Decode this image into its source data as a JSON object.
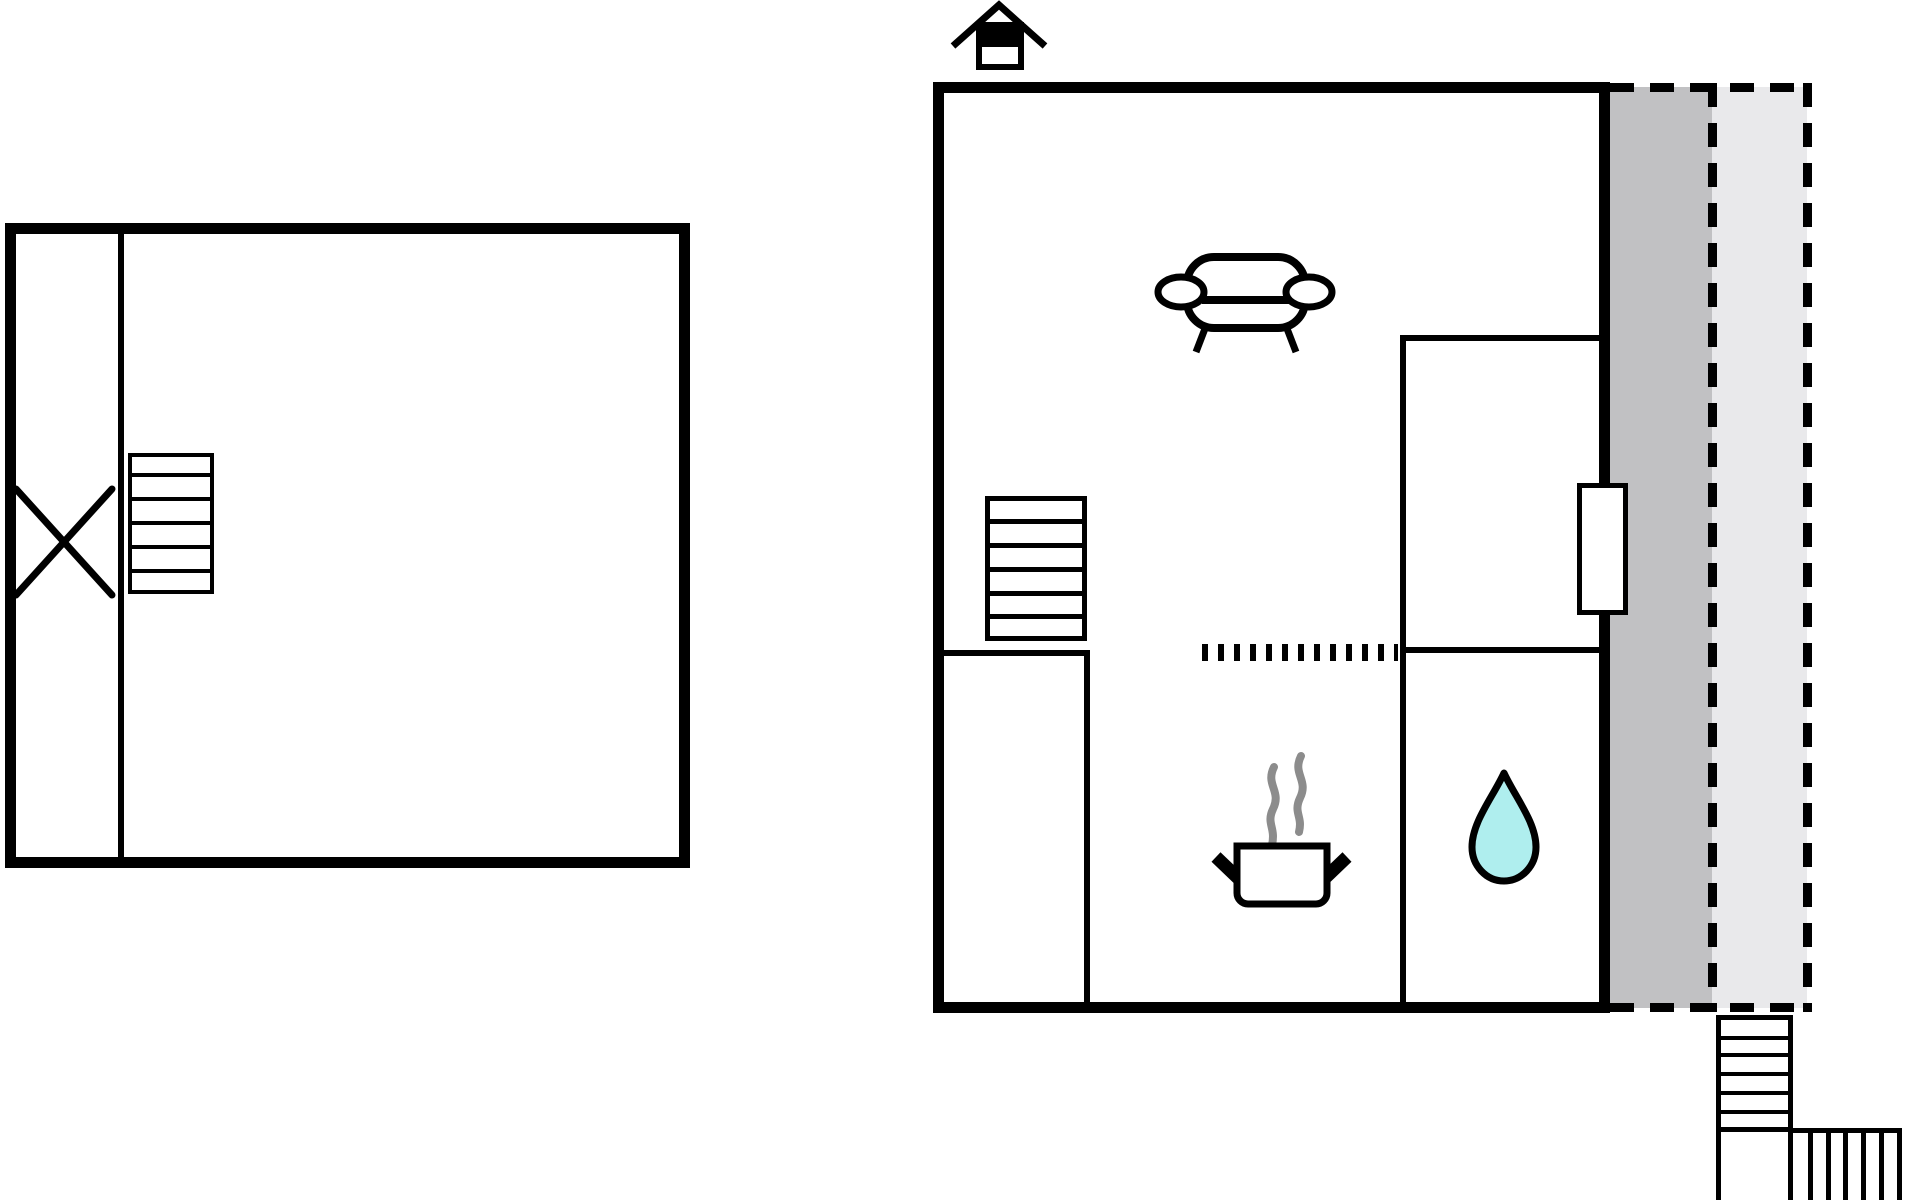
{
  "document": {
    "kind": "floor-plan-drawing",
    "visible_text": []
  },
  "colors": {
    "background": "#FFFFFF",
    "wall": "#000000",
    "terrace_covered": "#C1C1C3",
    "terrace_open": "#E9E9EB",
    "water": "#AFEEEE",
    "steam": "#8C8C8C",
    "white": "#FFFFFF"
  },
  "annex_building": {
    "name": "annex",
    "rooms": [
      "corridor",
      "main-room"
    ],
    "symbols": [
      {
        "icon": "cross-marker-icon",
        "meaning": "crossed-out area marker"
      },
      {
        "icon": "staircase-icon",
        "steps": 6
      }
    ]
  },
  "main_building": {
    "name": "main-house",
    "rooms": [
      "living-room",
      "hall",
      "kitchen",
      "bathroom",
      "bedroom"
    ],
    "symbols": [
      {
        "icon": "north-house-icon",
        "meaning": "entrance / orientation marker"
      },
      {
        "icon": "sofa-icon",
        "room": "living-room"
      },
      {
        "icon": "staircase-icon",
        "steps": 6,
        "room": "living-room"
      },
      {
        "icon": "open-threshold-dotted-line",
        "between": [
          "living-room",
          "kitchen"
        ]
      },
      {
        "icon": "cooking-pot-steam-icon",
        "room": "kitchen"
      },
      {
        "icon": "water-drop-icon",
        "room": "bathroom"
      },
      {
        "icon": "door-opening",
        "wall": "east"
      }
    ]
  },
  "terrace": {
    "outline": "dashed",
    "zones": [
      {
        "name": "covered-terrace",
        "color": "#C1C1C3"
      },
      {
        "name": "open-terrace",
        "color": "#E9E9EB"
      }
    ]
  },
  "exterior_stairs": {
    "flights": [
      {
        "direction": "vertical",
        "steps": 6
      },
      {
        "direction": "horizontal",
        "steps": 6
      }
    ]
  }
}
